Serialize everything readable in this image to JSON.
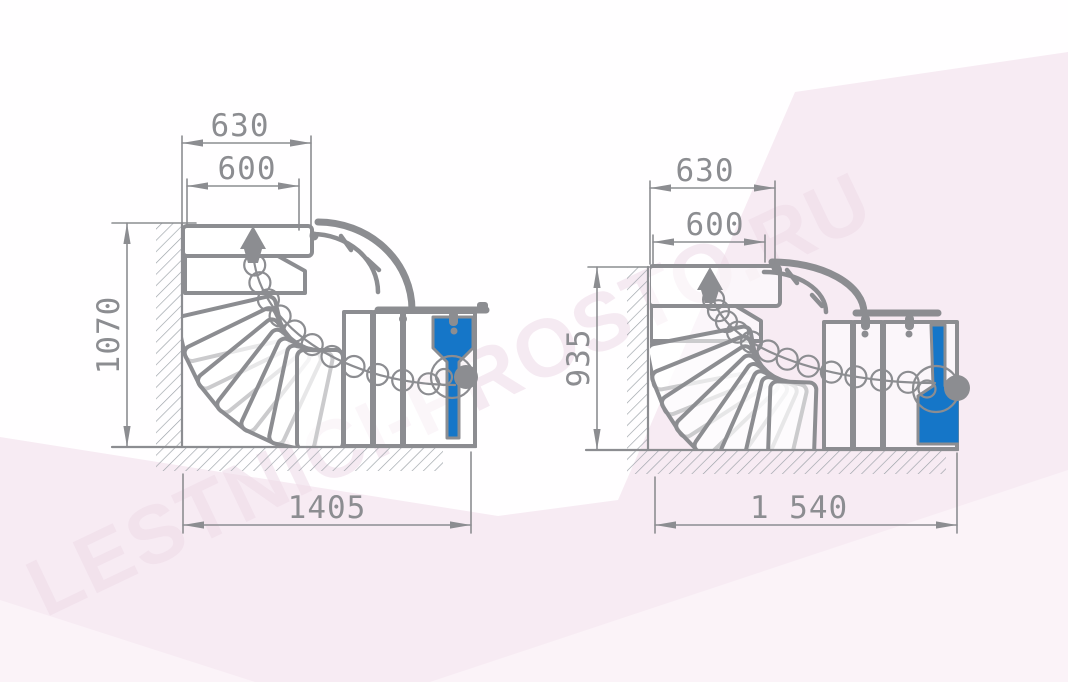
{
  "watermark": {
    "text": "LESTNICI-PROSTO.RU"
  },
  "colors": {
    "line_gray": "#8c8d91",
    "accent_blue": "#1576c8",
    "background_pink": "#f7ebf3",
    "background_pink_light": "#fbf3f8"
  },
  "left_diagram": {
    "title": "quarter-turn staircase plan, left variant",
    "dims": {
      "top_outer": "630",
      "top_inner": "600",
      "side_height": "1070",
      "bottom_width": "1405"
    }
  },
  "right_diagram": {
    "title": "quarter-turn staircase plan, right variant",
    "dims": {
      "top_outer": "630",
      "top_inner": "600",
      "side_height": "935",
      "bottom_width": "1 540"
    }
  }
}
